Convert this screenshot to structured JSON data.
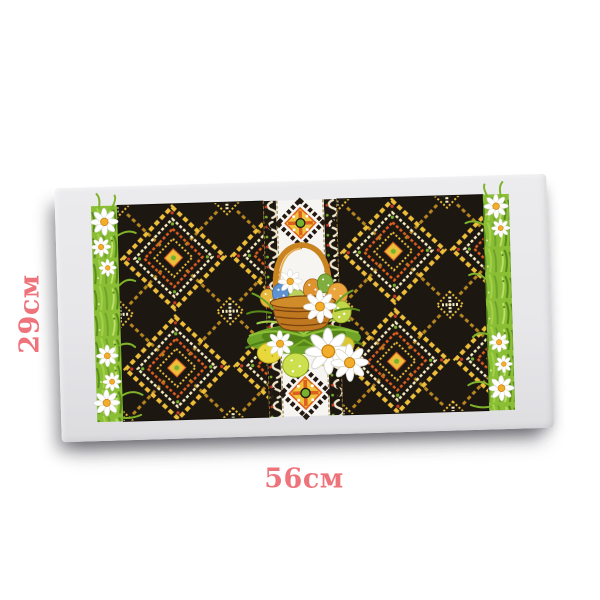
{
  "labels": {
    "height": "29см",
    "width": "56см"
  },
  "colors": {
    "page_background": "#ffffff",
    "label_pink": "#ee747c",
    "fabric_light": "#ececee",
    "fabric_dark": "#dcdcdf",
    "embroidery_black": "#1d1712",
    "embroidery_gold": "#edbe3a",
    "embroidery_cream": "#f5ecc0",
    "embroidery_orange": "#dc5f1e",
    "accent_green": "#76b32c",
    "grass_green": "#8abf35",
    "basket_brown": "#c07820",
    "daisy_center": "#f2ae2a"
  }
}
